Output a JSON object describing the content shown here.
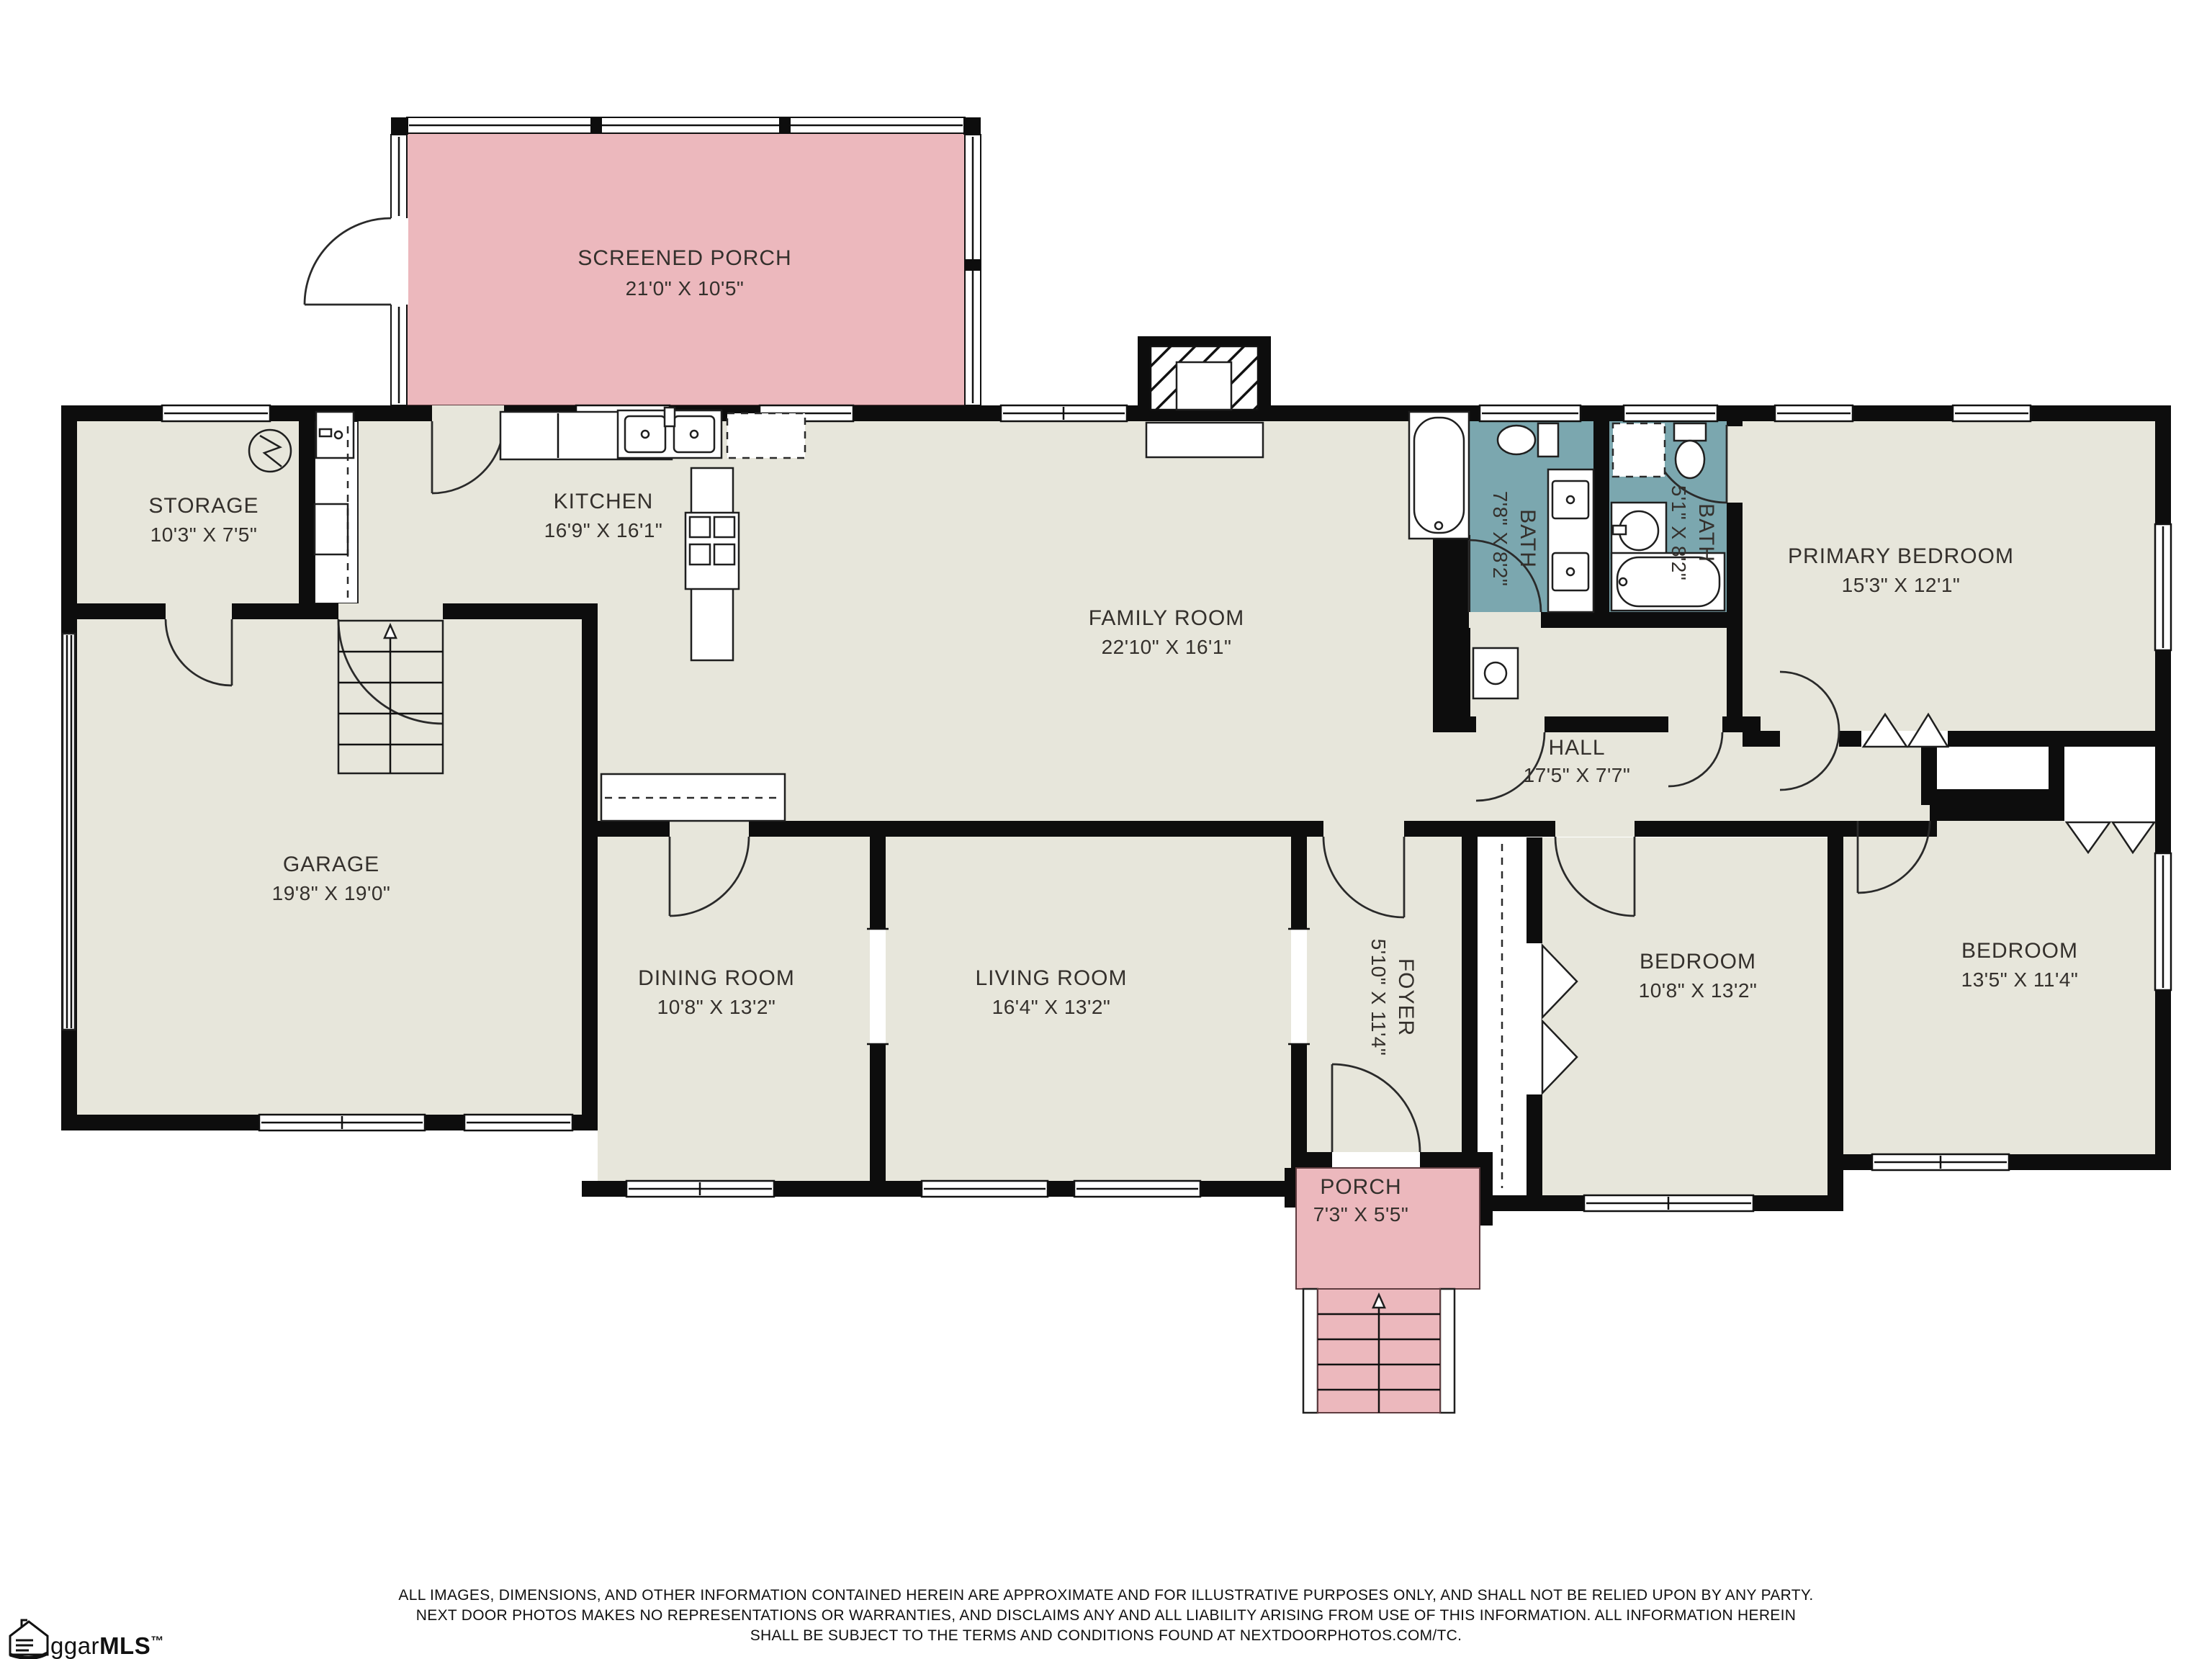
{
  "rooms": [
    {
      "id": "screened-porch",
      "label": "SCREENED PORCH",
      "dims": "21'0\" X 10'5\""
    },
    {
      "id": "storage",
      "label": "STORAGE",
      "dims": "10'3\" X 7'5\""
    },
    {
      "id": "kitchen",
      "label": "KITCHEN",
      "dims": "16'9\" X 16'1\""
    },
    {
      "id": "family-room",
      "label": "FAMILY ROOM",
      "dims": "22'10\" X 16'1\""
    },
    {
      "id": "bath-1",
      "label": "BATH",
      "dims": "7'8\" X 8'2\""
    },
    {
      "id": "bath-2",
      "label": "BATH",
      "dims": "5'1\" X 8'2\""
    },
    {
      "id": "primary-bedroom",
      "label": "PRIMARY BEDROOM",
      "dims": "15'3\" X 12'1\""
    },
    {
      "id": "hall",
      "label": "HALL",
      "dims": "17'5\" X 7'7\""
    },
    {
      "id": "garage",
      "label": "GARAGE",
      "dims": "19'8\" X 19'0\""
    },
    {
      "id": "dining-room",
      "label": "DINING ROOM",
      "dims": "10'8\" X 13'2\""
    },
    {
      "id": "living-room",
      "label": "LIVING ROOM",
      "dims": "16'4\" X 13'2\""
    },
    {
      "id": "foyer",
      "label": "FOYER",
      "dims": "5'10\" X 11'4\""
    },
    {
      "id": "bedroom-middle",
      "label": "BEDROOM",
      "dims": "10'8\" X 13'2\""
    },
    {
      "id": "bedroom-right",
      "label": "BEDROOM",
      "dims": "13'5\" X 11'4\""
    },
    {
      "id": "porch",
      "label": "PORCH",
      "dims": "7'3\" X 5'5\""
    }
  ],
  "footer": {
    "line1": "ALL IMAGES, DIMENSIONS, AND OTHER INFORMATION CONTAINED HEREIN ARE APPROXIMATE AND FOR ILLUSTRATIVE PURPOSES ONLY, AND SHALL NOT BE RELIED UPON BY ANY PARTY.",
    "line2": "NEXT DOOR PHOTOS MAKES NO REPRESENTATIONS OR WARRANTIES, AND DISCLAIMS ANY AND ALL LIABILITY ARISING FROM USE OF THIS INFORMATION. ALL INFORMATION HEREIN",
    "line3": "SHALL BE SUBJECT TO THE TERMS AND CONDITIONS FOUND AT NEXTDOORPHOTOS.COM/TC."
  },
  "logo": {
    "prefix": "ggar",
    "suffix": "MLS",
    "tm": "™"
  },
  "colors": {
    "floor": "#e7e6db",
    "wall": "#0d0d0d",
    "porch_pink": "#ecb8bd",
    "bath_teal": "#7ba7af",
    "line": "#1f1f1f"
  }
}
